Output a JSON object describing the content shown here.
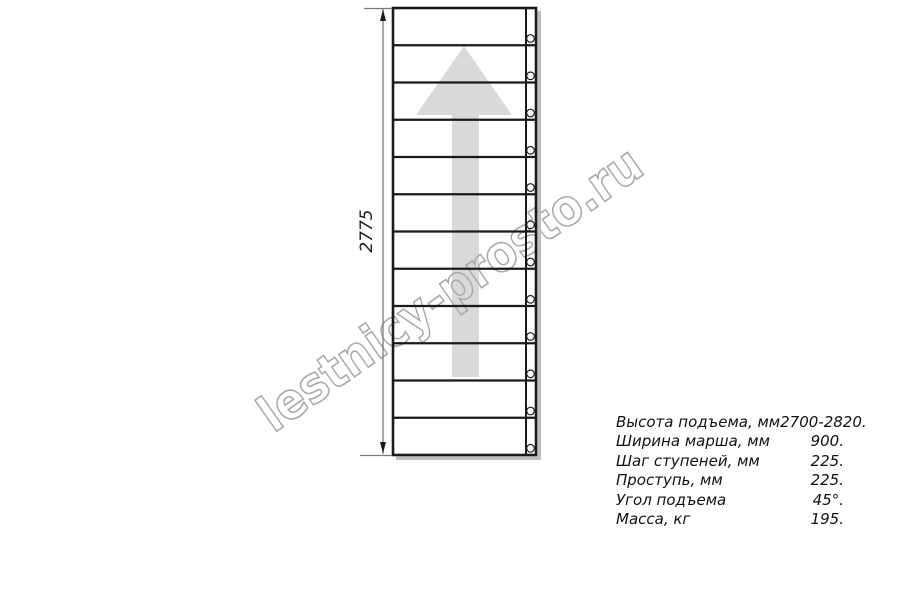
{
  "watermark": {
    "text": "lestnicy-prosto.ru"
  },
  "dimension": {
    "value": "2775"
  },
  "stairs": {
    "treads": 12,
    "description": "straight-flight-staircase-plan-view",
    "direction_arrow": "up-arrow"
  },
  "specs": {
    "rows": [
      {
        "label": "Высота подъема, мм",
        "value": "2700-2820."
      },
      {
        "label": "Ширина марша, мм",
        "value": "900."
      },
      {
        "label": "Шаг ступеней, мм",
        "value": "225."
      },
      {
        "label": "Проступь, мм",
        "value": "225."
      },
      {
        "label": "Угол подъема",
        "value": "45°."
      },
      {
        "label": "Масса, кг",
        "value": "195."
      }
    ]
  },
  "colors": {
    "line": "#1a1a1a",
    "arrow_fill": "#d9d9d9",
    "watermark_stroke": "#a9a9a9",
    "dimension_line": "#7a7a7a",
    "shadow": "#bdbdbd",
    "background": "#ffffff"
  }
}
